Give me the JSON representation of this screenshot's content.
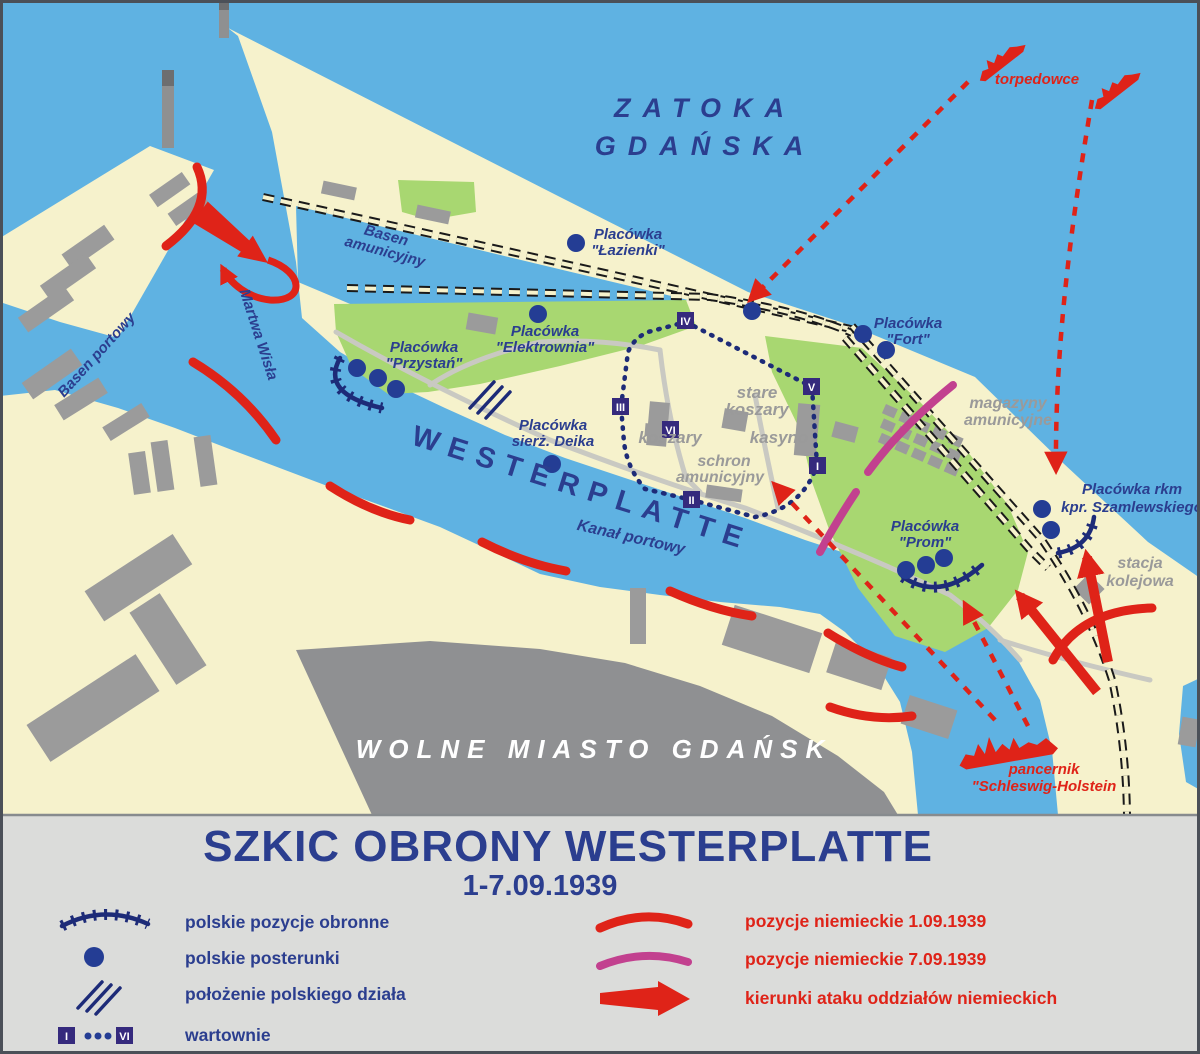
{
  "colors": {
    "sea": "#5fb2e2",
    "land": "#f6f2cc",
    "green": "#a8d771",
    "building": "#9b9b9b",
    "city": "#8f9092",
    "navy": "#2b3e8f",
    "navyline": "#1d2b78",
    "red": "#df2318",
    "magenta": "#c2418f",
    "badge": "#352a7d",
    "graytext": "#9a9a9a",
    "legendbg": "#dbdcda",
    "railblack": "#1a1a1a",
    "white": "#ffffff",
    "frame": "#4b5058"
  },
  "map": {
    "bay": {
      "line1": "ZATOKA",
      "line2": "GDAŃSKA"
    },
    "water_labels": {
      "basen_amunicyjny": {
        "line1": "Basen",
        "line2": "amunicyjny"
      },
      "basen_portowy": "Basen portowy",
      "martwa_wisla": "Martwa Wisła",
      "kanal_portowy": "Kanał portowy"
    },
    "region_labels": {
      "westerplatte": "WESTERPLATTE",
      "wolne_miasto": "WOLNE MIASTO GDAŃSK"
    },
    "outposts": {
      "lazienki": {
        "line1": "Placówka",
        "line2": "\"Łazienki\""
      },
      "elektrownia": {
        "line1": "Placówka",
        "line2": "\"Elektrownia\""
      },
      "przystan": {
        "line1": "Placówka",
        "line2": "\"Przystań\""
      },
      "fort": {
        "line1": "Placówka",
        "line2": "\"Fort\""
      },
      "deika": {
        "line1": "Placówka",
        "line2": "sierż. Deika"
      },
      "prom": {
        "line1": "Placówka",
        "line2": "\"Prom\""
      },
      "szamlewski": {
        "line1": "Placówka rkm",
        "line2": "kpr. Szamlewskiego"
      }
    },
    "site_labels": {
      "stare_koszary": {
        "line1": "stare",
        "line2": "koszary"
      },
      "koszary": "koszary",
      "kasyno": "kasyno",
      "schron": {
        "line1": "schron",
        "line2": "amunicyjny"
      },
      "magazyny": {
        "line1": "magazyny",
        "line2": "amunicyjne"
      },
      "stacja": {
        "line1": "stacja",
        "line2": "kolejowa"
      }
    },
    "german_labels": {
      "torpedowce": "torpedowce",
      "pancernik": {
        "line1": "pancernik",
        "line2": "\"Schleswig-Holstein"
      }
    },
    "guardhouses": {
      "i": "I",
      "ii": "II",
      "iii": "III",
      "iv": "IV",
      "v": "V",
      "vi": "VI"
    }
  },
  "legend": {
    "title": "SZKIC OBRONY WESTERPLATTE",
    "subtitle": "1-7.09.1939",
    "left": [
      {
        "icon": "polish-defense-arc",
        "label": "polskie pozycje obronne"
      },
      {
        "icon": "polish-post-dot",
        "label": "polskie posterunki"
      },
      {
        "icon": "polish-gun-hatch",
        "label": "położenie polskiego działa"
      },
      {
        "icon": "guardhouse-badges",
        "label": "wartownie"
      }
    ],
    "right": [
      {
        "icon": "german-arc-1-09",
        "label": "pozycje niemieckie 1.09.1939"
      },
      {
        "icon": "german-arc-7-09",
        "label": "pozycje niemieckie 7.09.1939"
      },
      {
        "icon": "attack-arrow",
        "label": "kierunki ataku oddziałów niemieckich"
      }
    ],
    "badge_first": "I",
    "badge_last": "VI"
  }
}
